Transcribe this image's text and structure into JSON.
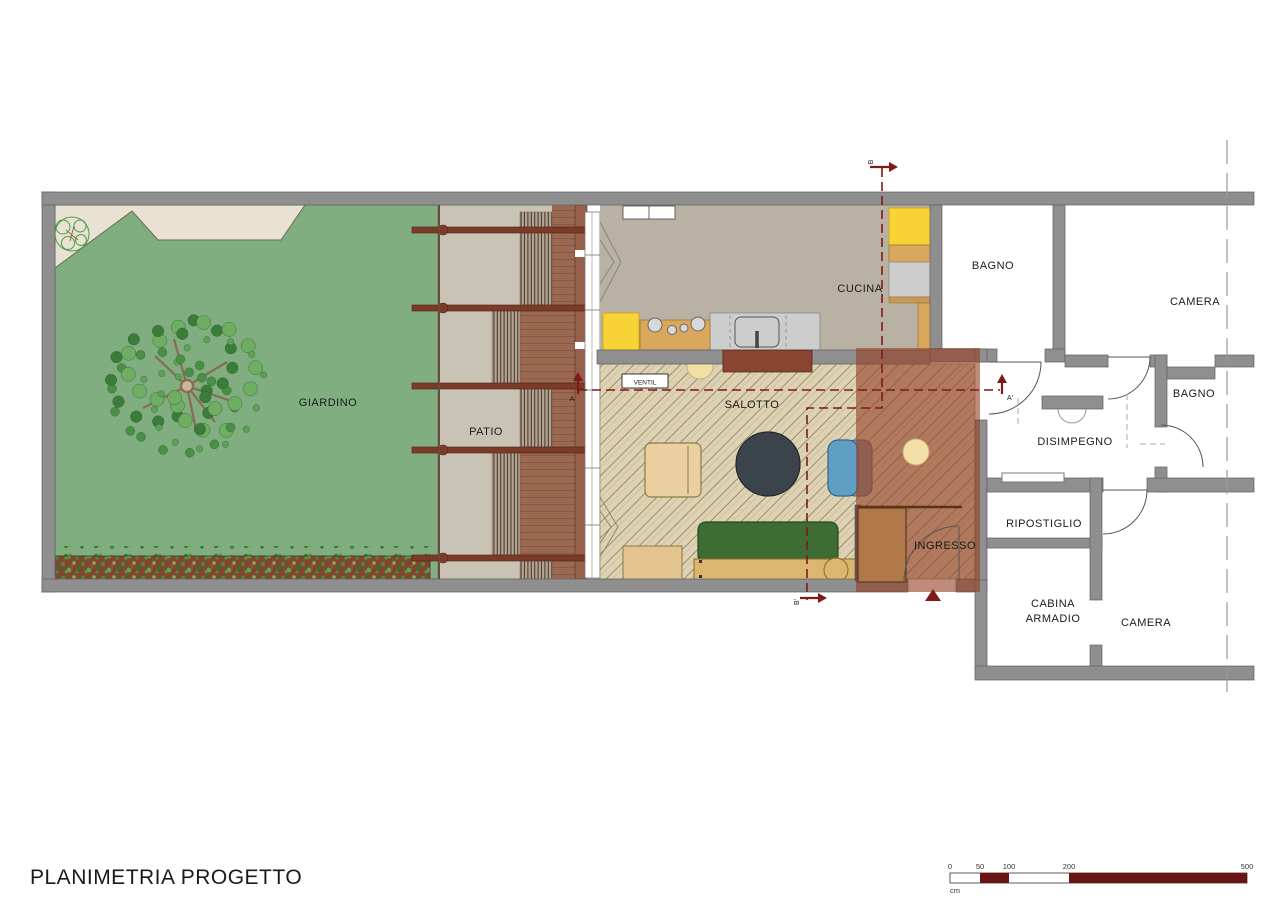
{
  "title": "PLANIMETRIA PROGETTO",
  "colors": {
    "title": "#72222f",
    "section_line": "#7e1a1a",
    "wall": "#8f8f8f",
    "garden_green": "#80ae81",
    "ingresso_overlay": "#943f24"
  },
  "rooms": {
    "giardino": "GIARDINO",
    "patio": "PATIO",
    "cucina": "CUCINA",
    "salotto": "SALOTTO",
    "ingresso": "INGRESSO",
    "bagno1": "BAGNO",
    "camera1": "CAMERA",
    "bagno2": "BAGNO",
    "disimpegno": "DISIMPEGNO",
    "ripostiglio": "RIPOSTIGLIO",
    "cabina_armadio_line1": "CABINA",
    "cabina_armadio_line2": "ARMADIO",
    "camera2": "CAMERA"
  },
  "annotations": {
    "ventil": "VENTIL",
    "section_a": "A",
    "section_a1": "A'",
    "section_b": "B",
    "section_b1": "B'"
  },
  "scale_bar": {
    "unit": "cm",
    "ticks": [
      "0",
      "50",
      "100",
      "200",
      "500"
    ],
    "segment_color": "#6b1414"
  }
}
